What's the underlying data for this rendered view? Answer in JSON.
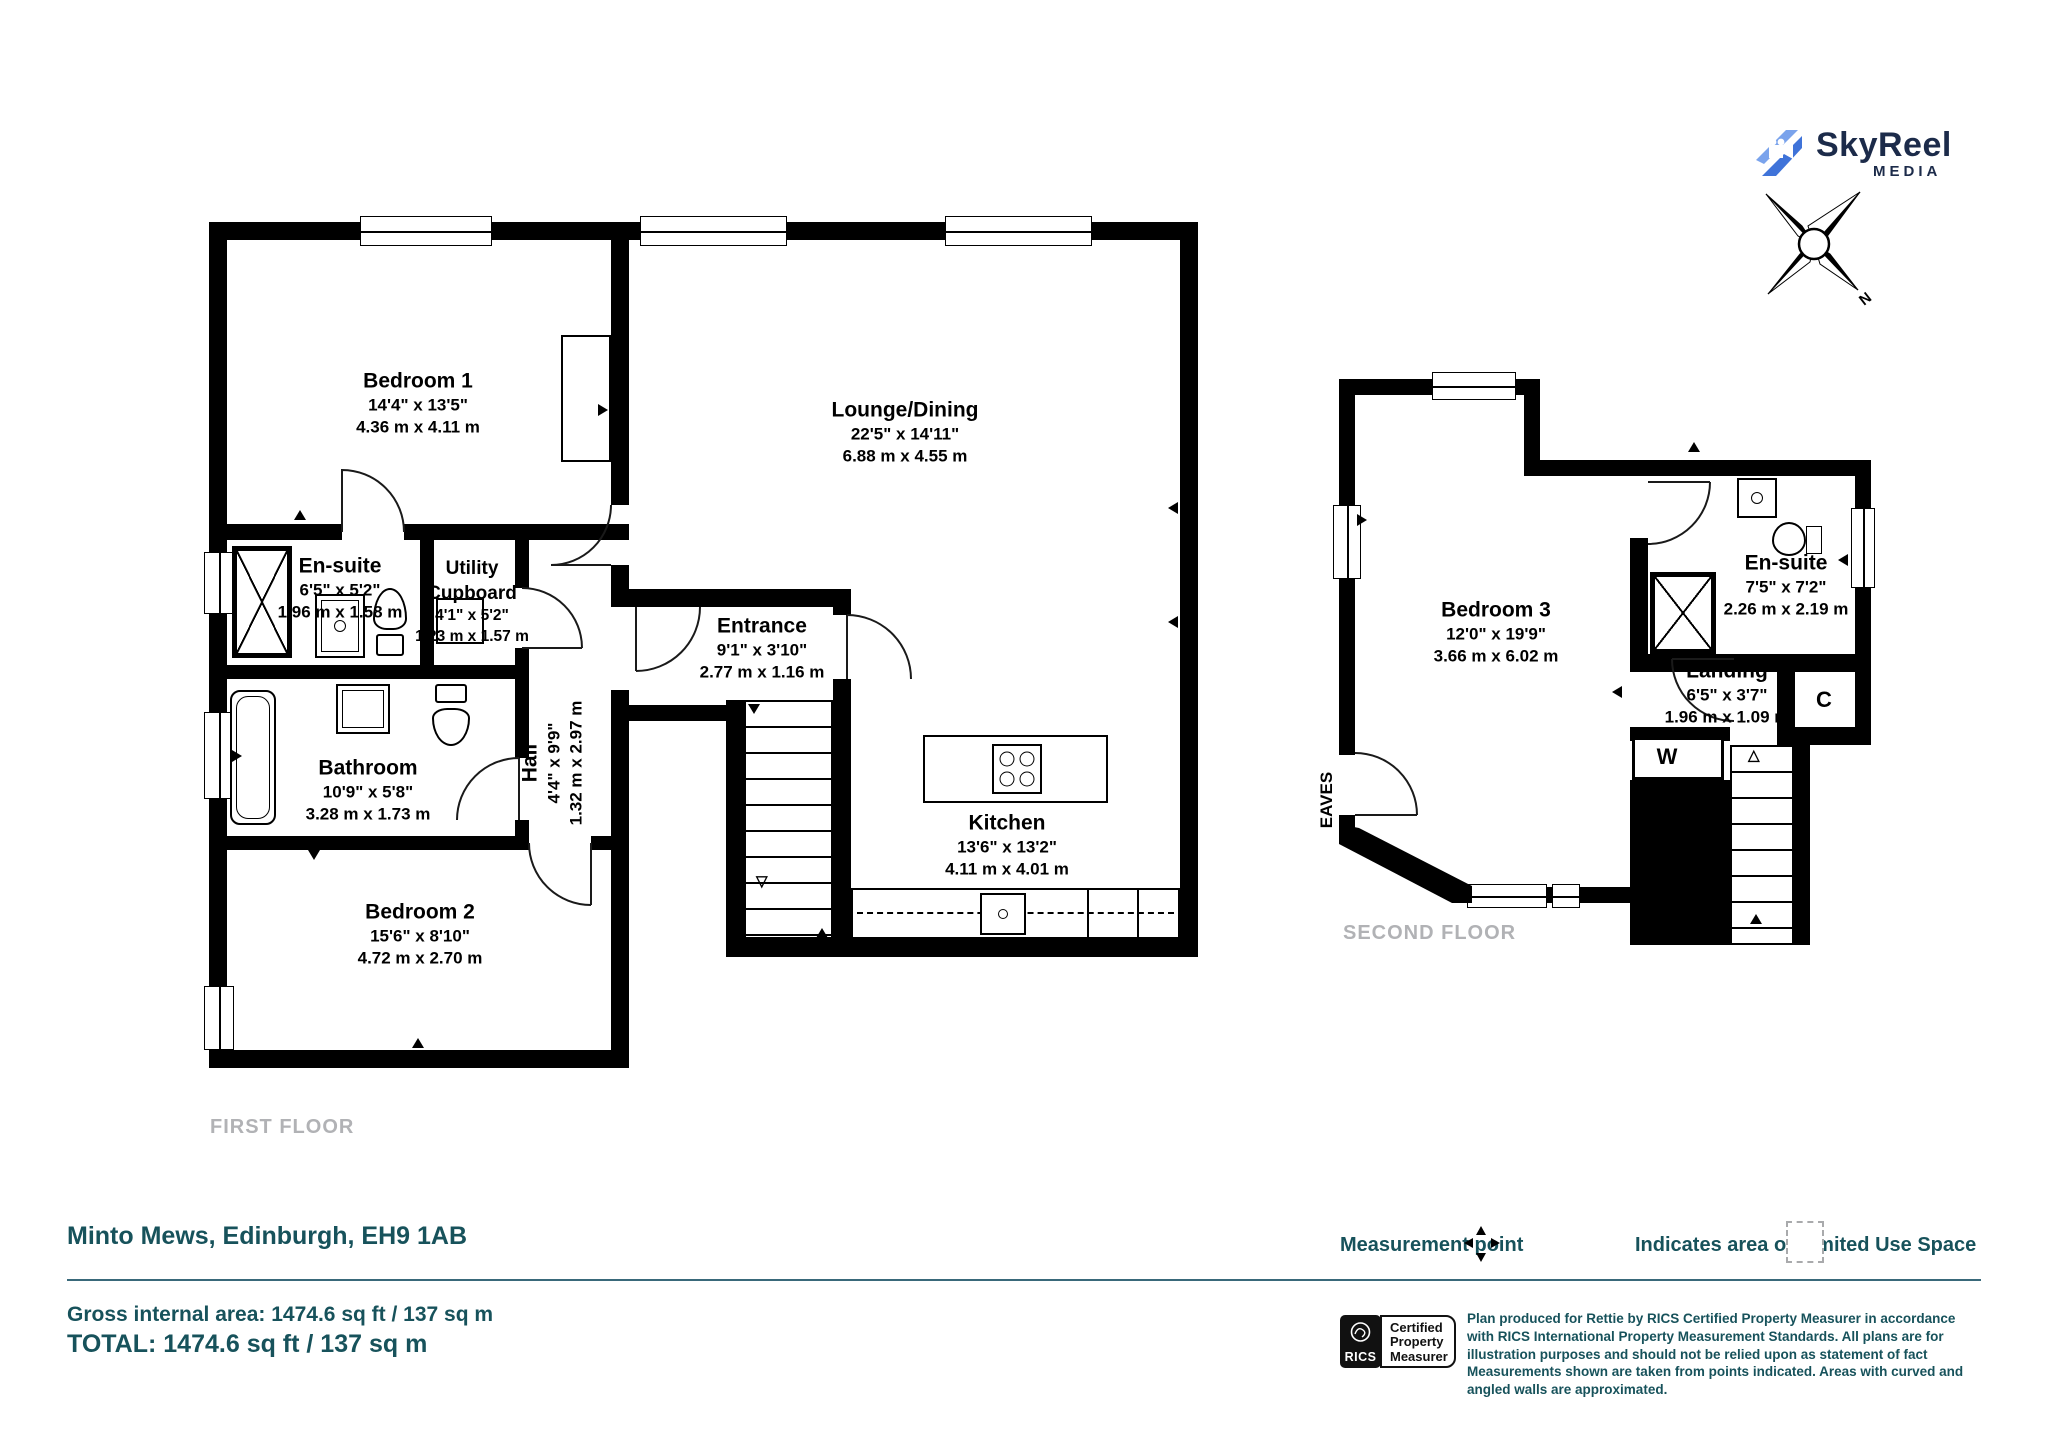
{
  "header": {
    "logo": {
      "name": "SkyReel",
      "tagline": "MEDIA"
    },
    "compass": {
      "north_label": "N"
    }
  },
  "icons": {
    "logo": "skyreel-camera-icon",
    "compass": "compass-rose-icon",
    "measurement_point": "four-way-arrows-icon",
    "limited_use": "dashed-square-swatch",
    "rics": "rics-lion-icon"
  },
  "first_floor": {
    "floor_label": "FIRST FLOOR",
    "rooms": {
      "bedroom1": {
        "name": "Bedroom 1",
        "imperial": "14'4\" x 13'5\"",
        "metric": "4.36 m x 4.11 m"
      },
      "lounge": {
        "name": "Lounge/Dining",
        "imperial": "22'5\" x 14'11\"",
        "metric": "6.88 m x 4.55 m"
      },
      "ensuite": {
        "name": "En-suite",
        "imperial": "6'5\" x 5'2\"",
        "metric": "1.96 m x 1.58 m"
      },
      "utility": {
        "name_line1": "Utility",
        "name_line2": "Cupboard",
        "imperial": "4'1\" x 5'2\"",
        "metric": "1.23 m x 1.57 m"
      },
      "entrance": {
        "name": "Entrance",
        "imperial": "9'1\" x 3'10\"",
        "metric": "2.77 m x 1.16 m"
      },
      "hall": {
        "name": "Hall",
        "imperial": "4'4\" x 9'9\"",
        "metric": "1.32 m x 2.97 m"
      },
      "bathroom": {
        "name": "Bathroom",
        "imperial": "10'9\" x 5'8\"",
        "metric": "3.28 m x 1.73 m"
      },
      "bedroom2": {
        "name": "Bedroom 2",
        "imperial": "15'6\" x 8'10\"",
        "metric": "4.72 m x 2.70 m"
      },
      "kitchen": {
        "name": "Kitchen",
        "imperial": "13'6\" x 13'2\"",
        "metric": "4.11 m x 4.01 m"
      }
    }
  },
  "second_floor": {
    "floor_label": "SECOND FLOOR",
    "eaves_label": "EAVES",
    "rooms": {
      "bedroom3": {
        "name": "Bedroom 3",
        "imperial": "12'0\" x 19'9\"",
        "metric": "3.66 m x 6.02 m"
      },
      "ensuite": {
        "name": "En-suite",
        "imperial": "7'5\" x 7'2\"",
        "metric": "2.26 m x 2.19 m"
      },
      "landing": {
        "name": "Landing",
        "imperial": "6'5\" x 3'7\"",
        "metric": "1.96 m x 1.09 m"
      },
      "cupboard": {
        "name": "C"
      },
      "wardrobe": {
        "name": "W"
      }
    }
  },
  "footer": {
    "address": "Minto Mews, Edinburgh, EH9 1AB",
    "gross_area": "Gross internal area: 1474.6 sq ft / 137 sq m",
    "total": "TOTAL: 1474.6 sq ft / 137 sq m",
    "legend": {
      "measurement_point": "Measurement point",
      "limited_use": "Indicates area of  Limited Use Space"
    },
    "rics": {
      "brand": "RICS",
      "line1": "Certified",
      "line2": "Property",
      "line3": "Measurer"
    },
    "disclaimer": "Plan produced for Rettie by RICS Certified Property Measurer in accordance with RICS International Property  Measurement Standards.  All plans are for illustration purposes and should not be relied upon as statement of fact Measurements shown are taken from points indicated. Areas with curved and angled walls are approximated."
  },
  "colors": {
    "teal": "#17525B",
    "wall": "#000000",
    "muted": "#B1B2B5",
    "logo_blue": "#4A80E0",
    "logo_navy": "#1C2B4A"
  }
}
